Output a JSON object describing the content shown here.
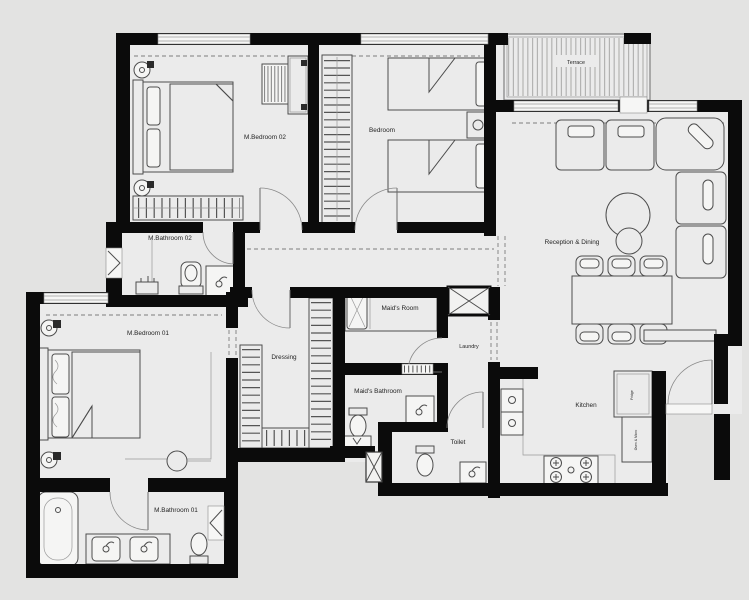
{
  "colors": {
    "background": "#e3e3e2",
    "floor": "#ebebeb",
    "wall": "#0b0b0b",
    "furniture_line": "#4d4d4d",
    "text": "#1f1f1f"
  },
  "rooms": {
    "m_bedroom_02": "M.Bedroom 02",
    "bedroom": "Bedroom",
    "terrace": "Terrace",
    "reception_dining": "Reception & Dining",
    "m_bathroom_02": "M.Bathroom 02",
    "m_bedroom_01": "M.Bedroom 01",
    "dressing": "Dressing",
    "maids_room": "Maid's Room",
    "laundry": "Laundry",
    "maids_bathroom": "Maid's Bathroom",
    "toilet": "Toilet",
    "kitchen": "Kitchen",
    "m_bathroom_01": "M.Bathroom 01"
  },
  "kitchen_units": {
    "tall_unit_1": "Fridge",
    "tall_unit_2": "Oven & Micro"
  }
}
